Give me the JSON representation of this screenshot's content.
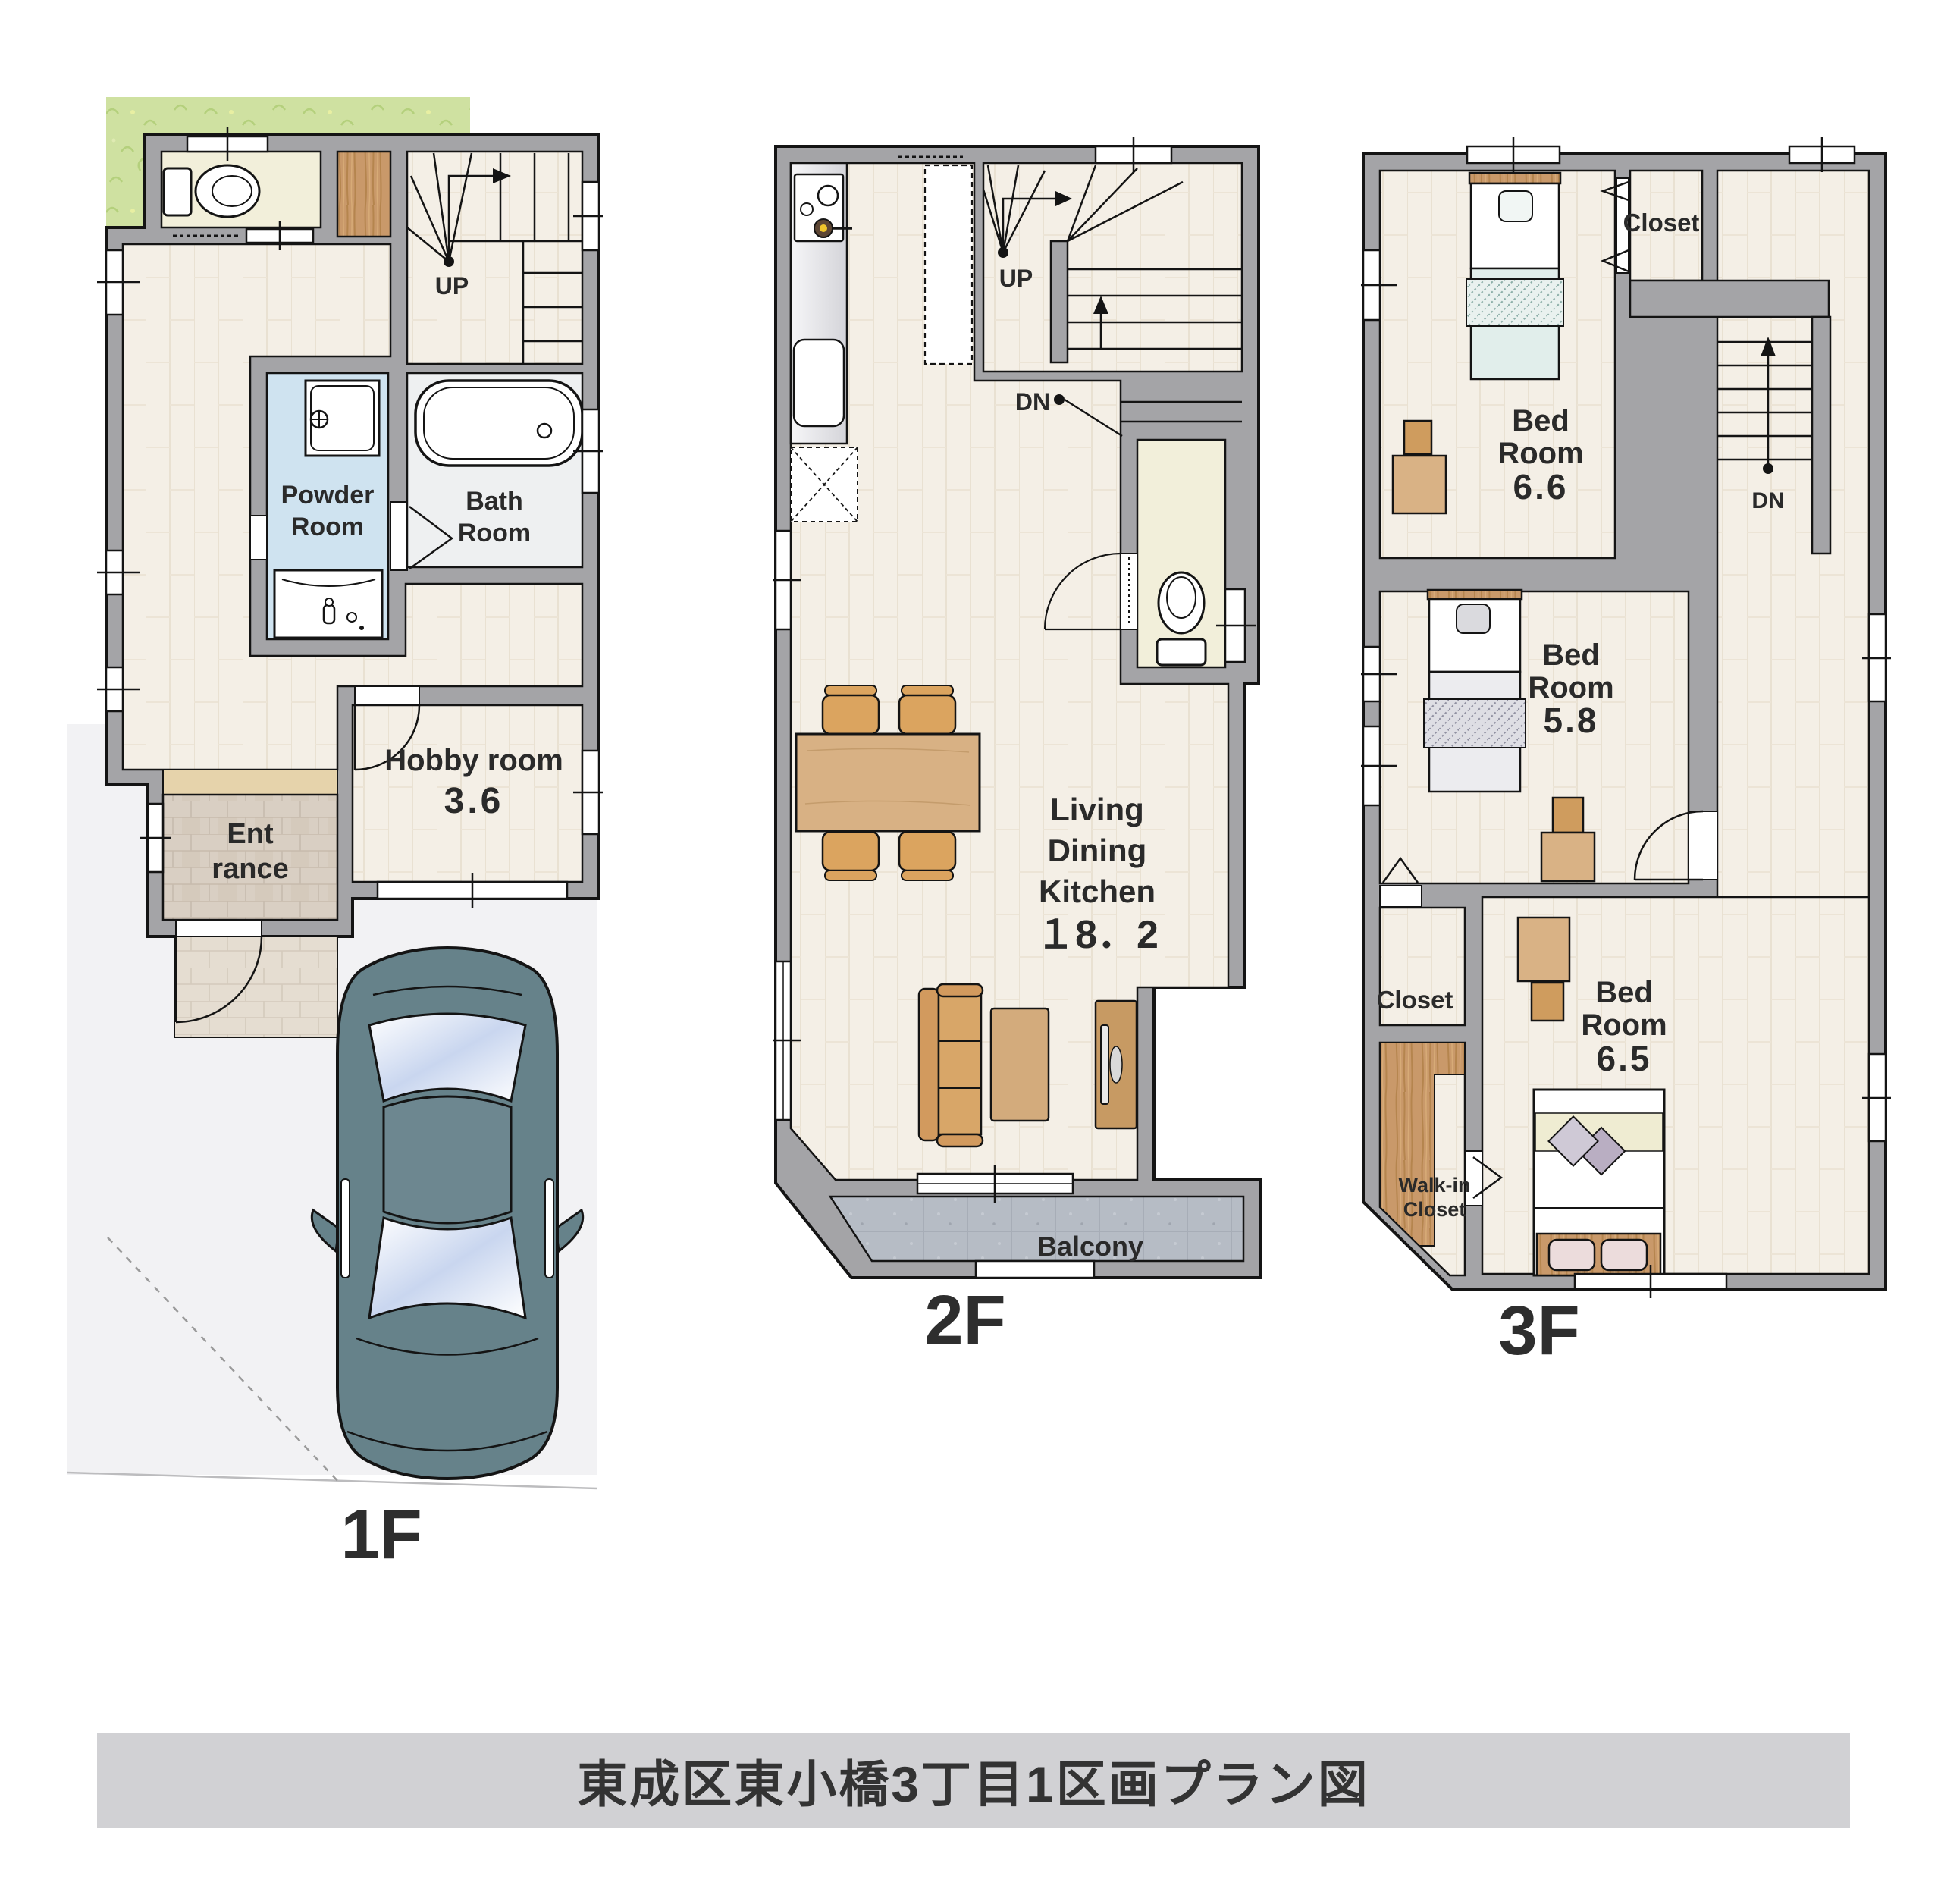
{
  "title": "東成区東小橋3丁目1区画プラン図",
  "f1": {
    "label": "1F",
    "up": "UP",
    "powder": [
      "Powder",
      "Room"
    ],
    "bath": [
      "Bath",
      "Room"
    ],
    "hobby": [
      "Hobby room",
      "3.6"
    ],
    "entrance": [
      "Ent",
      "rance"
    ]
  },
  "f2": {
    "label": "2F",
    "up": "UP",
    "dn": "DN",
    "ldk": [
      "Living",
      "Dining",
      "Kitchen",
      "１8．2"
    ],
    "balcony": "Balcony"
  },
  "f3": {
    "label": "3F",
    "dn": "DN",
    "closet_top": "Closet",
    "bed1": [
      "Bed",
      "Room",
      "6.6"
    ],
    "bed2": [
      "Bed",
      "Room",
      "5.8"
    ],
    "closet_mid": "Closet",
    "wic": [
      "Walk-in",
      "Closet"
    ],
    "bed3": [
      "Bed",
      "Room",
      "6.5"
    ]
  },
  "colors": {
    "wall": "#a4a4a7",
    "outline": "#141414",
    "grass": "#cfe1a1",
    "wood_floor": "#f4efe6",
    "powder_blue": "#cfe3f0",
    "sanitary_cream": "#f2efda",
    "entrance_tile": "#d9cfc3",
    "balcony_floor": "#b6bcc5",
    "furniture_wood": "#c9996a",
    "car_body": "#66828a",
    "banner_bg": "#d1d1d4",
    "label_text": "#2a2a2a"
  }
}
